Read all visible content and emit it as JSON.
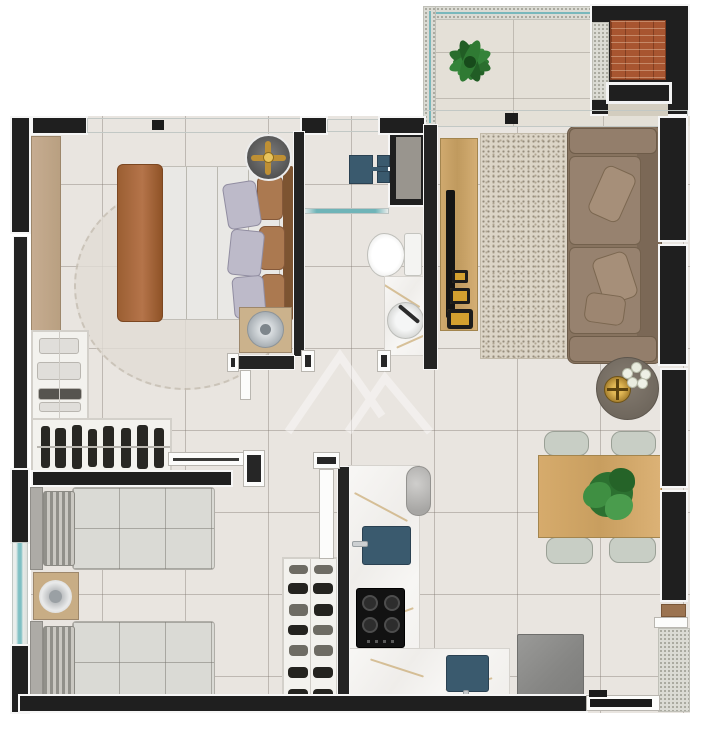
{
  "meta": {
    "type": "apartment-floor-plan",
    "view": "top-down-3d-render",
    "canvas": {
      "width": 709,
      "height": 750
    },
    "visible_text": "none"
  },
  "palette": {
    "wall": "#1f1f1f",
    "floor_tile": "#e9e5e0",
    "balcony_tile": "#e4e0d7",
    "glass_teal": "#7fc0c4",
    "railing_speckle": "#dbdbd4",
    "marble_counter": "#f5f4f2",
    "marble_vein_gold": "#be964e",
    "wood_furniture": "#c9a368",
    "wardrobe_tan": "#c0a588",
    "fixture_blue": "#3a5a6e",
    "sofa_brown": "#8d7867",
    "living_rug": "#dcd5c7",
    "bedding_gray": "#dadad5",
    "brick_grill": "#a85530",
    "fridge_gray": "#8d8d8b",
    "chair_sage": "#c8cec5",
    "plant_green": "#2e7a33"
  },
  "rooms": [
    {
      "name": "balcony",
      "items": [
        "glass-railing",
        "potted-plant",
        "brick-barbecue-grill",
        "grill-counter",
        "sliding-glass-door"
      ]
    },
    {
      "name": "master-bedroom",
      "items": [
        "double-bed",
        "brown-throw-blanket",
        "pillows",
        "headboard",
        "round-rug",
        "wardrobe-strip",
        "ceiling-fan",
        "nightstand-with-lamp",
        "window-band"
      ]
    },
    {
      "name": "walk-in-closet",
      "items": [
        "shelf-unit-folded-clothes",
        "hanging-rail-clothes",
        "sliding-door"
      ]
    },
    {
      "name": "bathroom",
      "items": [
        "shower-head",
        "shower-controls",
        "glass-partition",
        "toilet",
        "vanity-counter",
        "round-vessel-sink",
        "service-shaft"
      ]
    },
    {
      "name": "living-room",
      "items": [
        "tv-console",
        "tv",
        "decor-boxes",
        "textured-rug",
        "three-seat-sofa",
        "round-side-table",
        "gold-decor",
        "white-flowers"
      ]
    },
    {
      "name": "dining-area",
      "items": [
        "wooden-table",
        "chairs",
        "table-plant"
      ]
    },
    {
      "name": "kitchen",
      "items": [
        "l-shaped-marble-counter",
        "prep-sink",
        "main-sink",
        "cooktop",
        "column-cylinder",
        "refrigerator",
        "open-door"
      ]
    },
    {
      "name": "second-bedroom",
      "items": [
        "single-bed-a",
        "single-bed-b",
        "nightstand-with-dish",
        "shoe-rack",
        "side-window",
        "sliding-door"
      ]
    },
    {
      "name": "entry",
      "items": [
        "entrance-door",
        "external-corridor-speckled"
      ]
    }
  ],
  "counts": {
    "dining_chairs": 4,
    "cooktop_burners": 4,
    "shoe_rack_rows": 7,
    "hanging_clothes": 8,
    "sofa_seats": 2,
    "bed_pillows_master": 6
  },
  "watermark": {
    "present": true,
    "style": "faint white geometric mountain/chevron logo, center of plan"
  }
}
